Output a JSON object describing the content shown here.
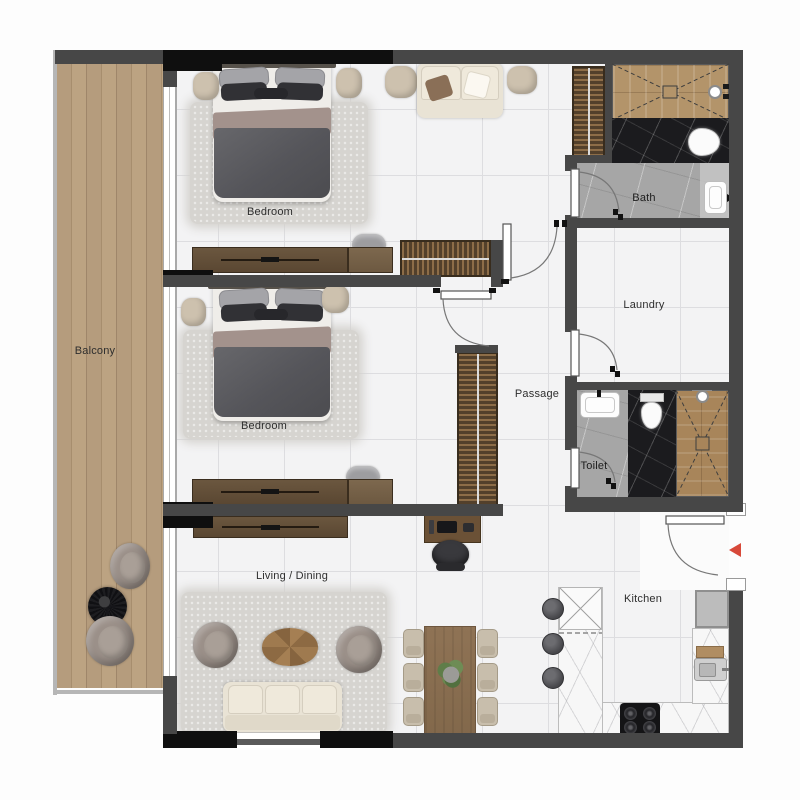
{
  "plan": {
    "type": "apartment-floor-plan",
    "rooms": {
      "balcony": {
        "label": "Balcony"
      },
      "bedroom_top": {
        "label": "Bedroom"
      },
      "bedroom_mid": {
        "label": "Bedroom"
      },
      "living_dining": {
        "label": "Living / Dining"
      },
      "passage": {
        "label": "Passage"
      },
      "bath": {
        "label": "Bath"
      },
      "laundry": {
        "label": "Laundry"
      },
      "toilet": {
        "label": "Toilet"
      },
      "kitchen": {
        "label": "Kitchen"
      }
    },
    "entrance_marker": {
      "icon": "entrance-arrow",
      "direction": "left",
      "color": "#d8493a"
    },
    "palette": {
      "wall": "#474747",
      "wall_accent": "#0f0f0f",
      "floor_tile": "#f3f3f4",
      "grid_line": "#dddde0",
      "balcony_wood": "#b29877",
      "furniture_wood_dark": "#5f4c39",
      "furniture_wood": "#8a6e51",
      "rug": "#d6d4d0",
      "marble_white": "#f7f7f7",
      "marble_black": "#1b1b1e",
      "bath_floor": "#a6a6a6",
      "upholstery_cream": "#e9e3d5",
      "upholstery_taupe": "#9b9089",
      "accent_red": "#d8493a"
    }
  }
}
